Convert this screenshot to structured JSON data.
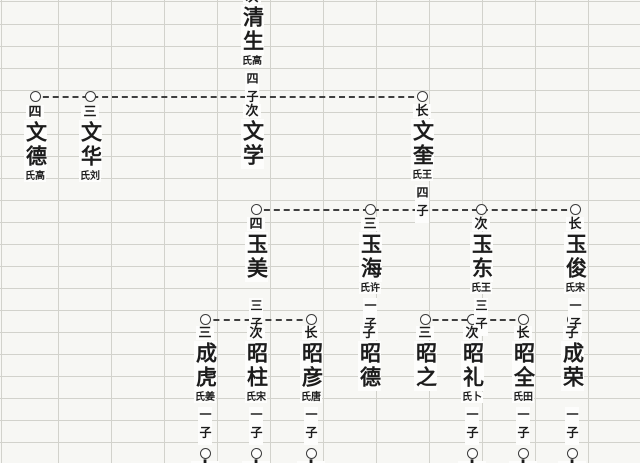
{
  "diagram": {
    "kind": "chinese-genealogy-family-tree",
    "ink_color": "#1c1c1c",
    "grid_color": "#d2d2cc",
    "background_color": "#f7f7f4",
    "node_symbol": "circle-outline",
    "line_style": "dashed"
  },
  "persons": {
    "qingsheng": {
      "prefix_cut": "次",
      "name": "清生",
      "spouse": "氏高",
      "sons": "四子"
    },
    "wende": {
      "prefix": "四",
      "name": "文德",
      "spouse": "氏高"
    },
    "wenhua": {
      "prefix": "三",
      "name": "文华",
      "spouse": "氏刘"
    },
    "wenxue": {
      "prefix": "次",
      "name": "文学"
    },
    "wenkui": {
      "prefix": "长",
      "name": "文奎",
      "spouse": "氏王",
      "sons": "四子"
    },
    "yumei": {
      "prefix": "四",
      "name": "玉美",
      "sons": "三子"
    },
    "yuhai": {
      "prefix": "三",
      "name": "玉海",
      "spouse": "氏许",
      "sons": "一子"
    },
    "yudong": {
      "prefix": "次",
      "name": "玉东",
      "spouse": "氏王",
      "sons": "三子"
    },
    "yujun": {
      "prefix": "长",
      "name": "玉俊",
      "spouse": "氏宋",
      "sons": "一子"
    },
    "chenghu": {
      "prefix": "三",
      "name": "成虎",
      "spouse": "氏姜",
      "sons": "一子",
      "tail": "十"
    },
    "zhaozhu": {
      "prefix": "次",
      "name": "昭柱",
      "spouse": "氏宋",
      "sons": "一子",
      "tail": "十"
    },
    "zhaoyan": {
      "prefix": "长",
      "name": "昭彦",
      "spouse": "氏唐",
      "sons": "一子",
      "tail": "十"
    },
    "zhaode": {
      "prefix": "子",
      "name": "昭德"
    },
    "zhaozhi": {
      "prefix": "三",
      "name": "昭之"
    },
    "zhaoli": {
      "prefix": "次",
      "name": "昭礼",
      "spouse": "氏卜",
      "sons": "一子",
      "tail": "十"
    },
    "zhaoquan": {
      "prefix": "长",
      "name": "昭全",
      "spouse": "氏田",
      "sons": "一子",
      "tail": "十"
    },
    "chengrong": {
      "prefix": "子",
      "name": "成荣",
      "sons": "一子",
      "tail": "十"
    }
  }
}
